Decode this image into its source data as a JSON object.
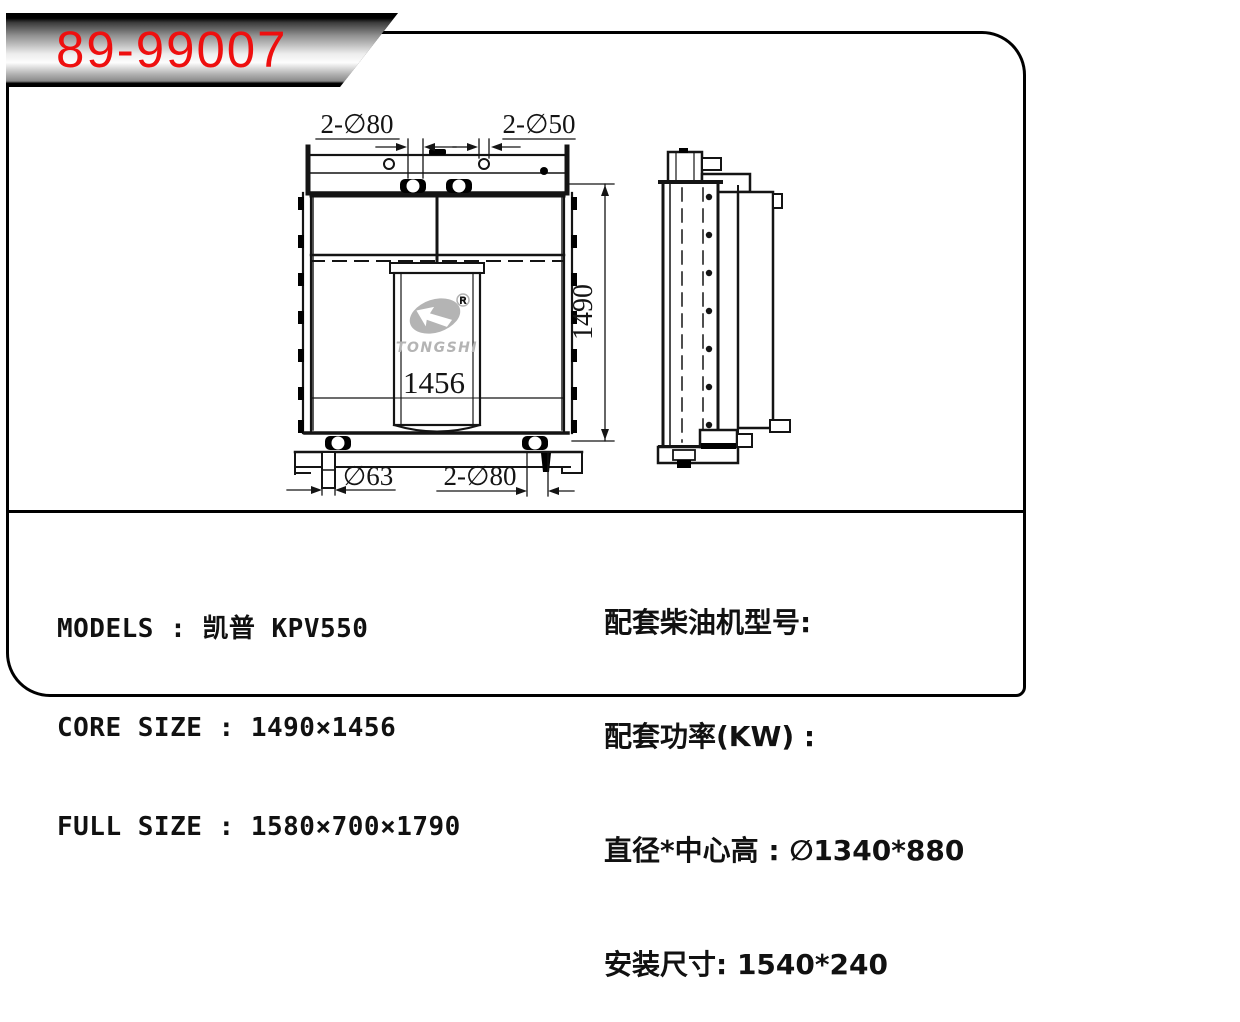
{
  "banner": {
    "part_number": "89-99007"
  },
  "drawing": {
    "logo": {
      "brand": "TONGSHI",
      "registered": "R"
    },
    "dims": {
      "top_left": "2-∅80",
      "top_right": "2-∅50",
      "height": "1490",
      "core_width": "1456",
      "drain": "∅63",
      "bottom": "2-∅80"
    }
  },
  "specs": {
    "left": [
      "MODELS : 凯普 KPV550",
      "CORE SIZE : 1490×1456",
      "FULL SIZE : 1580×700×1790"
    ],
    "right": [
      "配套柴油机型号:",
      "配套功率(KW) :",
      "直径*中心高 : ∅1340*880",
      "安装尺寸: 1540*240"
    ]
  }
}
